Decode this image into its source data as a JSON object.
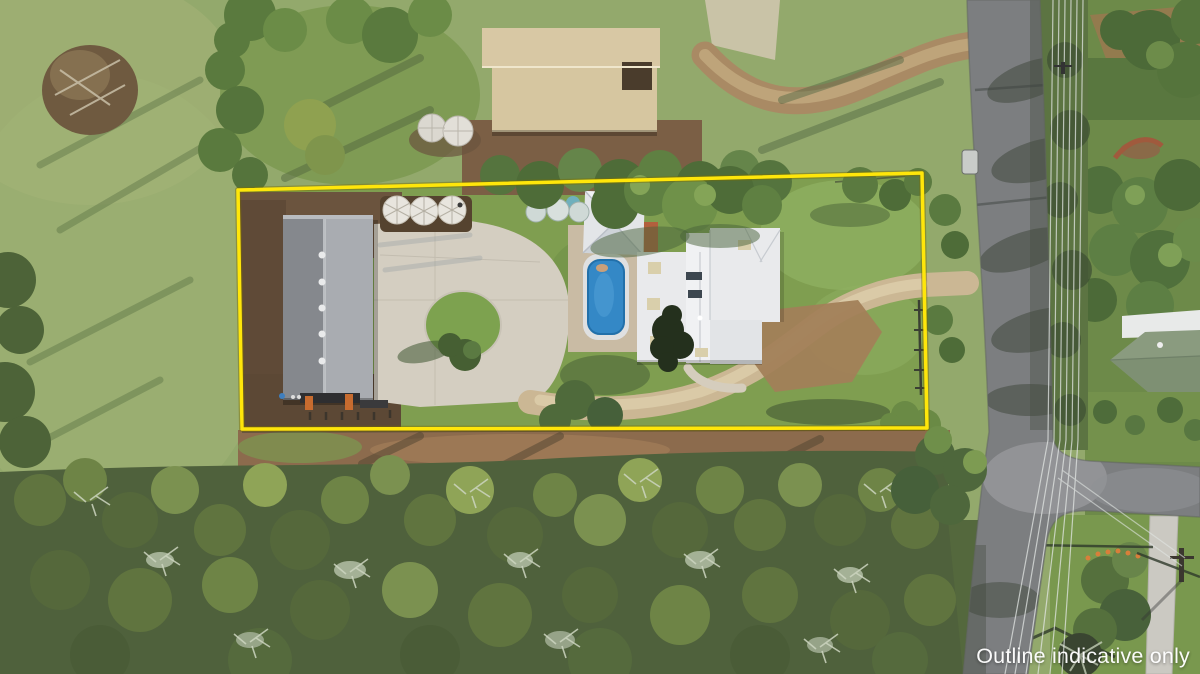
{
  "image": {
    "kind": "aerial-drone-photo",
    "description": "Aerial view of an acreage property outlined in yellow: large grey-roofed shed with concrete apron and water tanks, white-roofed house with blue pool and gazebo, gravel driveway to a road on the right, open paddock to the left and dense bushland below."
  },
  "watermark": {
    "text": "Outline indicative only",
    "color": "#ffffff"
  },
  "overlay": {
    "boundary_color": "#ffe60a"
  },
  "palette": {
    "paddock": "#93a96c",
    "lawn": "#7f9e50",
    "bush": "#4f613c",
    "road": "#7c7e80",
    "concrete": "#d4cec1",
    "driveway": "#cbb794",
    "dirt": "#6b543e",
    "barn_roof": "#d8c8a4",
    "shed_roof_left": "#85888d",
    "shed_roof_right": "#a9acb1",
    "house_roof": "#e9eaec",
    "pool_water": "#3488c6",
    "neighbour_roof": "#8a9b7f"
  },
  "scene": {
    "features": [
      "paddock",
      "brush-pile",
      "barn-shed",
      "water-tanks",
      "boundary-outline",
      "main-shed",
      "concrete-apron",
      "grass-island",
      "gravel-driveway",
      "house",
      "swimming-pool",
      "gazebo",
      "lawn",
      "bushland",
      "road",
      "intersection",
      "footpath",
      "power-lines",
      "neighbour-house",
      "watermark"
    ]
  }
}
